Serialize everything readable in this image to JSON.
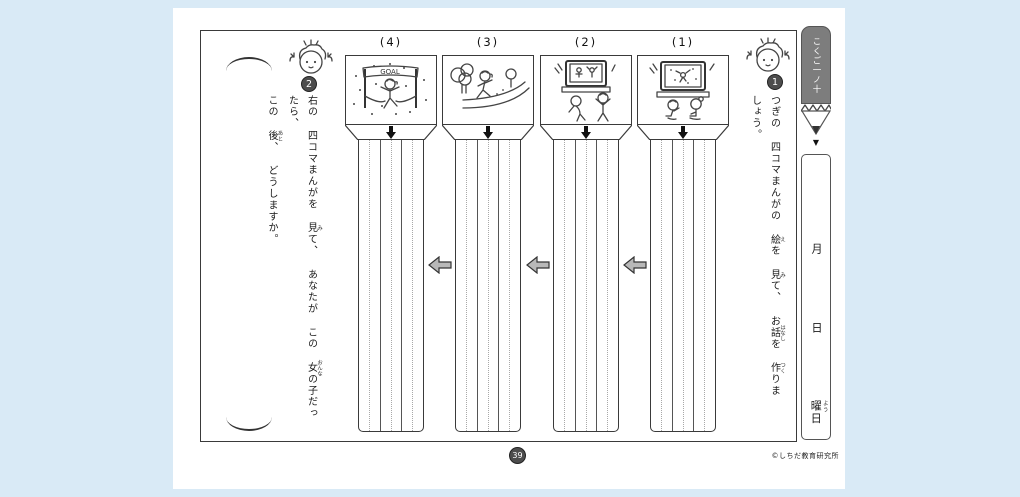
{
  "page": {
    "background_color": "#d9eaf6",
    "paper_color": "#ffffff",
    "page_number": "39",
    "copyright": "©しちだ教育研究所"
  },
  "header_tab": {
    "subject_label": "こくご一ノ十",
    "shape": "pencil",
    "body_color": "#7d7d7d",
    "pointer_icon": "▼"
  },
  "date_column": {
    "month_label": "月",
    "day_label": "日",
    "weekday_text": "曜日",
    "weekday_segments": [
      {
        "t": "曜",
        "r": "よう"
      },
      {
        "t": "日"
      }
    ]
  },
  "questions": {
    "q1": {
      "number": "1",
      "text": "つぎの 四コマまんがの 絵を 見て、お話を 作りましょう。",
      "segments": [
        {
          "t": "つぎの 四コマまんがの "
        },
        {
          "t": "絵",
          "r": "え"
        },
        {
          "t": "を "
        },
        {
          "t": "見",
          "r": "み"
        },
        {
          "t": "て、 お"
        },
        {
          "t": "話",
          "r": "はなし"
        },
        {
          "t": "を "
        },
        {
          "t": "作",
          "r": "つく"
        },
        {
          "t": "りましょう。"
        }
      ]
    },
    "q2": {
      "number": "2",
      "text": "右の 四コマまんがを 見て、あなたが この 女の子だったら、この 後、どうしますか。",
      "line1_segments": [
        {
          "t": "右の 四コマまんがを "
        },
        {
          "t": "見",
          "r": "み"
        },
        {
          "t": "て、 あなたが この "
        },
        {
          "t": "女",
          "r": "おんな"
        },
        {
          "t": "の子だったら、"
        }
      ],
      "line2_segments": [
        {
          "t": "この "
        },
        {
          "t": "後",
          "r": "あと"
        },
        {
          "t": "、 どうしますか。"
        }
      ]
    }
  },
  "panels": [
    {
      "label": "(4)",
      "scene": "girl bursting through the finish tape under a GOAL banner with confetti",
      "banner_text": "GOAL"
    },
    {
      "label": "(3)",
      "scene": "girl jogging along a curved path between trees"
    },
    {
      "label": "(2)",
      "scene": "two children exercising along with the program shown on TV"
    },
    {
      "label": "(1)",
      "scene": "two children sitting on the floor watching a marathon on TV"
    }
  ],
  "answer_area": {
    "column_count": 4,
    "lines_per_column": 3,
    "flow_direction": "right-to-left"
  },
  "icons": {
    "down_arrow": "⬇",
    "left_arrow": "⬅",
    "pencil_pointer": "▼",
    "bracket_top": "︵",
    "bracket_bottom": "︶"
  }
}
